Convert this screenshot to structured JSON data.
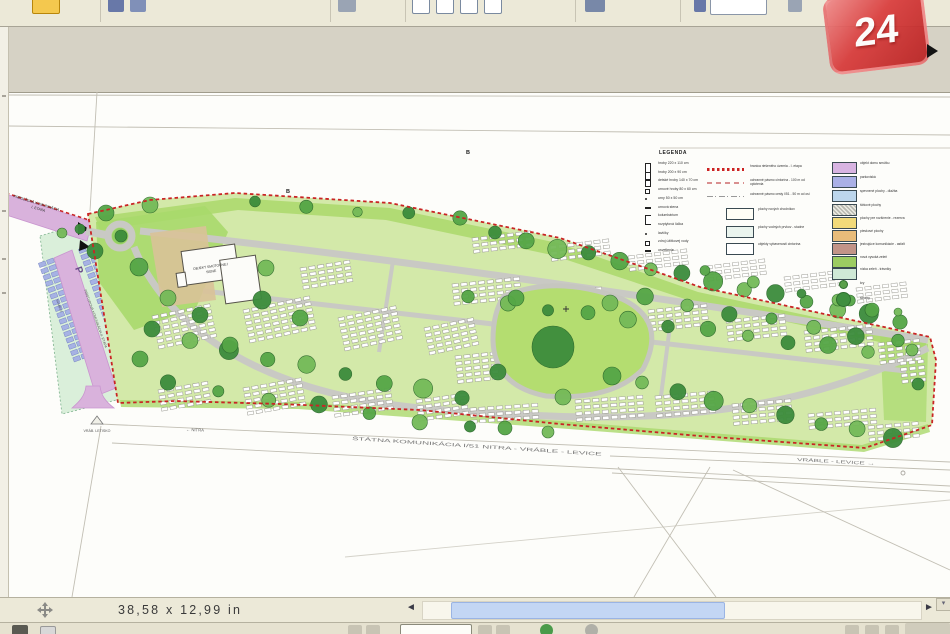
{
  "app": {
    "statusbar": {
      "page_dimensions": "38,58 x 12,99 in",
      "scroll_left": "◄",
      "scroll_right": "►",
      "corner_arrow": "▾"
    },
    "watermark": {
      "text": "24"
    }
  },
  "plan": {
    "colors": {
      "boundary": "#c92525",
      "site_green": "#d3e9a9",
      "accent_green": "#aad86b",
      "path_gray": "#c9c9c4",
      "road_purple": "#d9b2dc",
      "parking_blue": "#a6b2e4",
      "parking_mint": "#daefda",
      "plaza_tan": "#d9c298",
      "lawn_green": "#b4dd70",
      "tree_dark": "#3c8c3c"
    },
    "labels": {
      "ext_road_line1": "PREDĹŽENÁ KOMUNIKÁCIA",
      "ext_road_line2": "I. ETAPA",
      "parking_p": "P",
      "parking_road": "PRÍSTUPOVÁ KOMUNIKÁCIA II. ETAPA",
      "parking_count_left": "54 MIEST",
      "parking_count_right": "54 MIEST",
      "building_line1": "OBJEKT SMÚTOČNEJ",
      "building_line2": "SIENE",
      "marker_b_1": "B",
      "marker_b_2": "B",
      "road_nitra": "← NITRA",
      "road_main": "ŠTÁTNA KOMUNIKÁCIA I/51 NITRA - VRÁBLE - LEVICE",
      "road_right": "VRÁBLE - LEVICE →",
      "airfield": "VRÁB. LETISKO"
    },
    "legend": {
      "title": "LEGENDA",
      "symbol_items": [
        {
          "sym": "rect-tall",
          "label": "hroby 220 x 110 cm"
        },
        {
          "sym": "rect",
          "label": "hroby 200 x 90 cm"
        },
        {
          "sym": "sq",
          "label": "detské hroby 140 x 70 cm"
        },
        {
          "sym": "sq-sm",
          "label": "urnové hroby 80 x 60 cm"
        },
        {
          "sym": "dot",
          "label": "urny 50 x 50 cm"
        },
        {
          "sym": "bar",
          "label": "urnová stena"
        },
        {
          "sym": "bracket",
          "label": "kolumbárium"
        },
        {
          "sym": "dash",
          "label": "rozptylová lúčka"
        },
        {
          "sym": "dot",
          "label": "lavičky"
        },
        {
          "sym": "sq-sm",
          "label": "zdroj úžitkovej vody"
        },
        {
          "sym": "dash",
          "label": "osvetlenie"
        }
      ],
      "line_items": [
        {
          "style": "red-dots",
          "label": "hranica riešeného územia - I. etapa"
        },
        {
          "style": "pink-dash",
          "label": "ochranné pásmo cintorína - 100 m od oplotenia"
        },
        {
          "style": "gray-dashdot",
          "label": "ochranné pásmo cesty I/51 - 50 m od osi"
        }
      ],
      "box_items": [
        {
          "fill": "#fffef6",
          "label": "plochy nových chodníkov"
        },
        {
          "fill": "#eaf4ee",
          "label": "plochy vodných prvkov - studne"
        },
        {
          "fill": "#ffffff",
          "label": "objekty vybavenosti cintorína"
        }
      ],
      "swatch_items": [
        {
          "fill": "#d8b4e2",
          "label": "objekt domu smútku"
        },
        {
          "fill": "#aab0e6",
          "label": "parkoviská"
        },
        {
          "fill": "#bcd6ec",
          "label": "spevnené plochy - dlažba"
        },
        {
          "fill": "hatch",
          "label": "štrkové plochy"
        },
        {
          "fill": "#f2da7a",
          "label": "plochy pre rozšírenie - rezerva"
        },
        {
          "fill": "#e8bc7a",
          "label": "pieskové plochy"
        },
        {
          "fill": "#c29488",
          "label": "jestvujúce komunikácie - asfalt"
        },
        {
          "fill": "#9ccc62",
          "label": "nová vysoká zeleň"
        },
        {
          "fill": "#cfe9d6",
          "label": "nízka zeleň - trávniky"
        }
      ],
      "tree_items": [
        {
          "size": "small",
          "label": "kry"
        },
        {
          "size": "large",
          "label": "stromy"
        }
      ]
    },
    "grave_blocks": [
      [
        152,
        316,
        -12,
        7,
        6
      ],
      [
        243,
        310,
        -12,
        8,
        6
      ],
      [
        338,
        318,
        -12,
        7,
        6
      ],
      [
        424,
        328,
        -12,
        6,
        5
      ],
      [
        158,
        390,
        -10,
        6,
        4
      ],
      [
        243,
        388,
        -10,
        7,
        5
      ],
      [
        332,
        396,
        -8,
        7,
        4
      ],
      [
        416,
        400,
        -8,
        6,
        4
      ],
      [
        452,
        284,
        -6,
        8,
        4
      ],
      [
        534,
        294,
        -6,
        8,
        4
      ],
      [
        455,
        356,
        -6,
        5,
        5
      ],
      [
        470,
        408,
        -4,
        8,
        3
      ],
      [
        575,
        400,
        -4,
        8,
        4
      ],
      [
        472,
        238,
        -7,
        7,
        3
      ],
      [
        550,
        246,
        -7,
        7,
        3
      ],
      [
        628,
        256,
        -7,
        7,
        3
      ],
      [
        706,
        266,
        -7,
        7,
        3
      ],
      [
        784,
        277,
        -7,
        7,
        3
      ],
      [
        856,
        288,
        -7,
        6,
        3
      ],
      [
        648,
        310,
        -6,
        7,
        4
      ],
      [
        726,
        320,
        -6,
        7,
        4
      ],
      [
        804,
        331,
        -6,
        8,
        4
      ],
      [
        878,
        343,
        -6,
        5,
        4
      ],
      [
        655,
        396,
        -5,
        7,
        4
      ],
      [
        732,
        404,
        -5,
        7,
        4
      ],
      [
        808,
        414,
        -5,
        8,
        3
      ],
      [
        868,
        426,
        -5,
        6,
        3
      ],
      [
        300,
        268,
        -9,
        6,
        4
      ],
      [
        900,
        362,
        -6,
        3,
        4
      ]
    ],
    "parking_bands": [
      {
        "x": 53,
        "y": 258,
        "rot": 70,
        "cols": 16,
        "rows": 2,
        "cw": 4.5,
        "ch": 7,
        "gx": 2.2,
        "gy": 1.6
      },
      {
        "x": 93,
        "y": 244,
        "rot": 70,
        "cols": 16,
        "rows": 2,
        "cw": 4.5,
        "ch": 7,
        "gx": 2.2,
        "gy": 1.6
      }
    ],
    "tree_rows": [
      [
        495,
        234,
        900,
        322,
        14,
        8
      ],
      [
        468,
        298,
        868,
        352,
        11,
        7
      ],
      [
        190,
        342,
        462,
        398,
        8,
        8
      ],
      [
        168,
        384,
        470,
        428,
        7,
        7
      ],
      [
        645,
        298,
        898,
        342,
        7,
        7
      ],
      [
        642,
        384,
        893,
        438,
        8,
        8
      ],
      [
        255,
        203,
        460,
        218,
        5,
        6
      ],
      [
        705,
        272,
        898,
        312,
        5,
        5
      ]
    ],
    "trees": [
      [
        553,
        347,
        21
      ],
      [
        516,
        298,
        8
      ],
      [
        610,
        303,
        8
      ],
      [
        498,
        372,
        8
      ],
      [
        612,
        376,
        9
      ],
      [
        563,
        397,
        8
      ],
      [
        121,
        236,
        6
      ],
      [
        106,
        213,
        8
      ],
      [
        150,
        205,
        8
      ],
      [
        95,
        251,
        8
      ],
      [
        139,
        267,
        9
      ],
      [
        168,
        298,
        8
      ],
      [
        152,
        329,
        8
      ],
      [
        140,
        359,
        8
      ],
      [
        266,
        268,
        8
      ],
      [
        262,
        300,
        9
      ],
      [
        300,
        318,
        8
      ],
      [
        912,
        350,
        6
      ],
      [
        918,
        384,
        6
      ],
      [
        872,
        310,
        7
      ],
      [
        838,
        300,
        6
      ],
      [
        200,
        315,
        8
      ],
      [
        230,
        345,
        8
      ],
      [
        62,
        233,
        5
      ],
      [
        80,
        229,
        5
      ],
      [
        505,
        428,
        7
      ],
      [
        548,
        432,
        6
      ]
    ]
  }
}
